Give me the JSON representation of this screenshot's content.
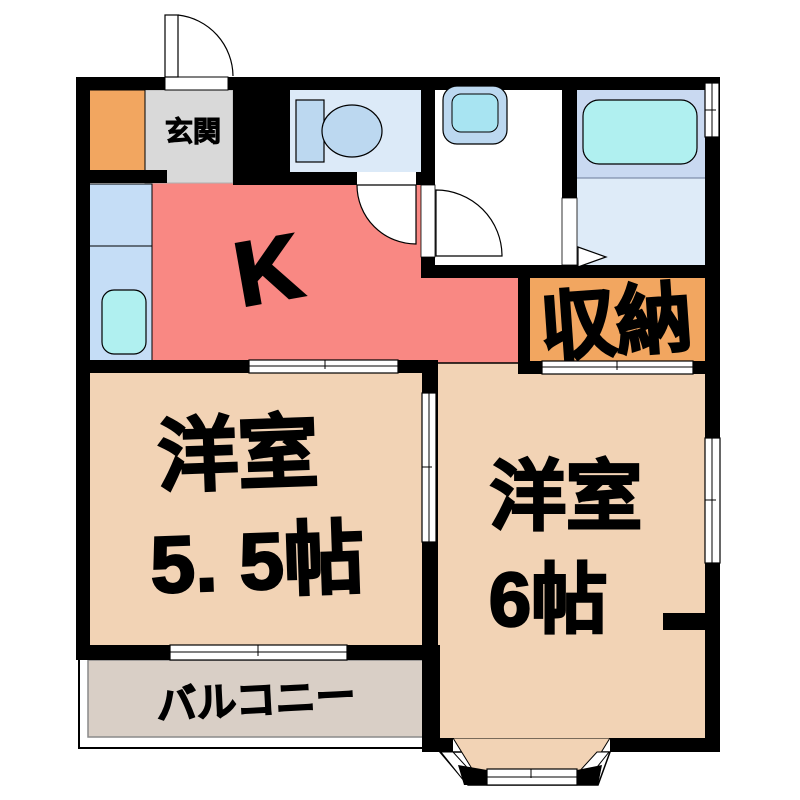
{
  "floor_plan": {
    "type": "apartment-floor-plan",
    "labels": {
      "entrance": "玄関",
      "kitchen": "K",
      "storage": "収納",
      "room1_name": "洋室",
      "room1_size": "5. 5帖",
      "room2_name": "洋室",
      "room2_size": "6帖",
      "balcony": "バルコニー"
    },
    "rooms": [
      {
        "name": "玄関",
        "type": "entrance-hall"
      },
      {
        "name": "K",
        "type": "kitchen"
      },
      {
        "name": "収納",
        "type": "storage-closet"
      },
      {
        "name": "洋室 5. 5帖",
        "type": "western-style-room",
        "size_jo": 5.5
      },
      {
        "name": "洋室 6帖",
        "type": "western-style-room",
        "size_jo": 6
      },
      {
        "name": "バルコニー",
        "type": "balcony"
      }
    ],
    "fixtures": [
      "toilet-icon",
      "washbasin-icon",
      "bathtub-icon",
      "kitchen-sink-icon",
      "shoe-cabinet",
      "hinged-door-arc",
      "folding-door-marker",
      "sliding-door-symbol",
      "window-symbol",
      "bay-window"
    ],
    "colors": {
      "wall": "#000000",
      "kitchen_floor": "#F98883",
      "room_floor": "#F2D3B5",
      "balcony_floor": "#D9CFC6",
      "storage_floor": "#F2A660",
      "entrance_floor": "#D9D9D9",
      "counter_blue": "#C5DDF6",
      "toilet_room_blue": "#DCEAF8",
      "bathroom_blue": "#C9D9F1",
      "bathroom_lower_blue": "#DEEBF8",
      "fixture_blue": "#BCD8F0",
      "water_cyan": "#B0F0F0"
    }
  }
}
